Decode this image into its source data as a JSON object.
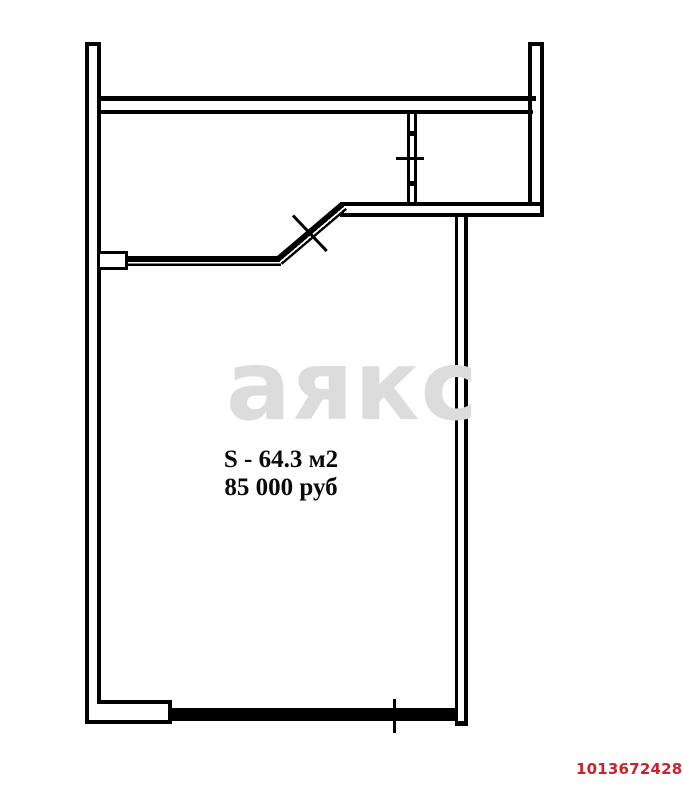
{
  "plan": {
    "watermark": "аякс",
    "area_label": "S - 64.3 м2",
    "price_label": "85 000 руб",
    "listing_id": "1013672428",
    "colors": {
      "wall_line": "#000000",
      "background": "#ffffff",
      "watermark": "#dcdcdc",
      "listing_id": "#cb2227"
    }
  }
}
